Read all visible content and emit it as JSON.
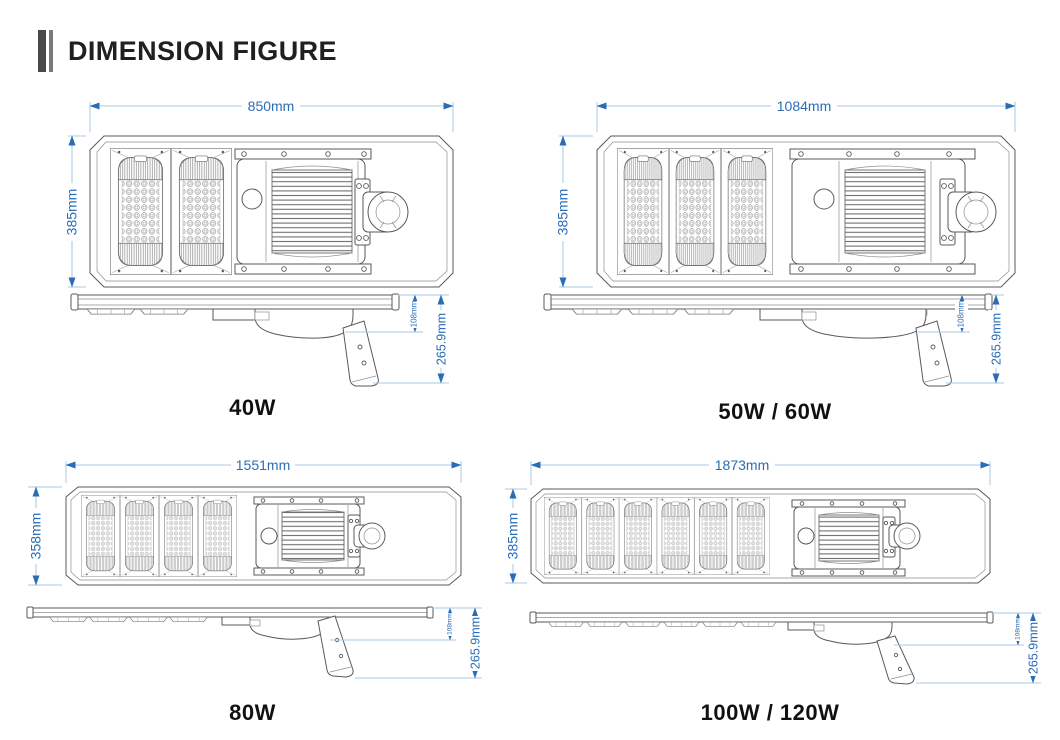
{
  "header": {
    "title": "DIMENSION FIGURE"
  },
  "colors": {
    "dimension_line": "#a9c9e5",
    "dimension_accent": "#2a6db5",
    "drawing_line": "#5a5a5a",
    "drawing_line_light": "#8f8f8f",
    "label_text": "#111111",
    "accent_bar_dark": "#4a4a4a",
    "accent_bar_light": "#7a7a7a"
  },
  "panels": [
    {
      "label": "40W",
      "top_width": "850mm",
      "side_height": "385mm",
      "drop_height": "108mm",
      "total_height": "265.9mm",
      "led_modules": 2
    },
    {
      "label": "50W / 60W",
      "top_width": "1084mm",
      "side_height": "385mm",
      "drop_height": "108mm",
      "total_height": "265.9mm",
      "led_modules": 3
    },
    {
      "label": "80W",
      "top_width": "1551mm",
      "side_height": "358mm",
      "drop_height": "108mm",
      "total_height": "265.9mm",
      "led_modules": 4
    },
    {
      "label": "100W / 120W",
      "top_width": "1873mm",
      "side_height": "385mm",
      "drop_height": "108mm",
      "total_height": "265.9mm",
      "led_modules": 6
    }
  ]
}
